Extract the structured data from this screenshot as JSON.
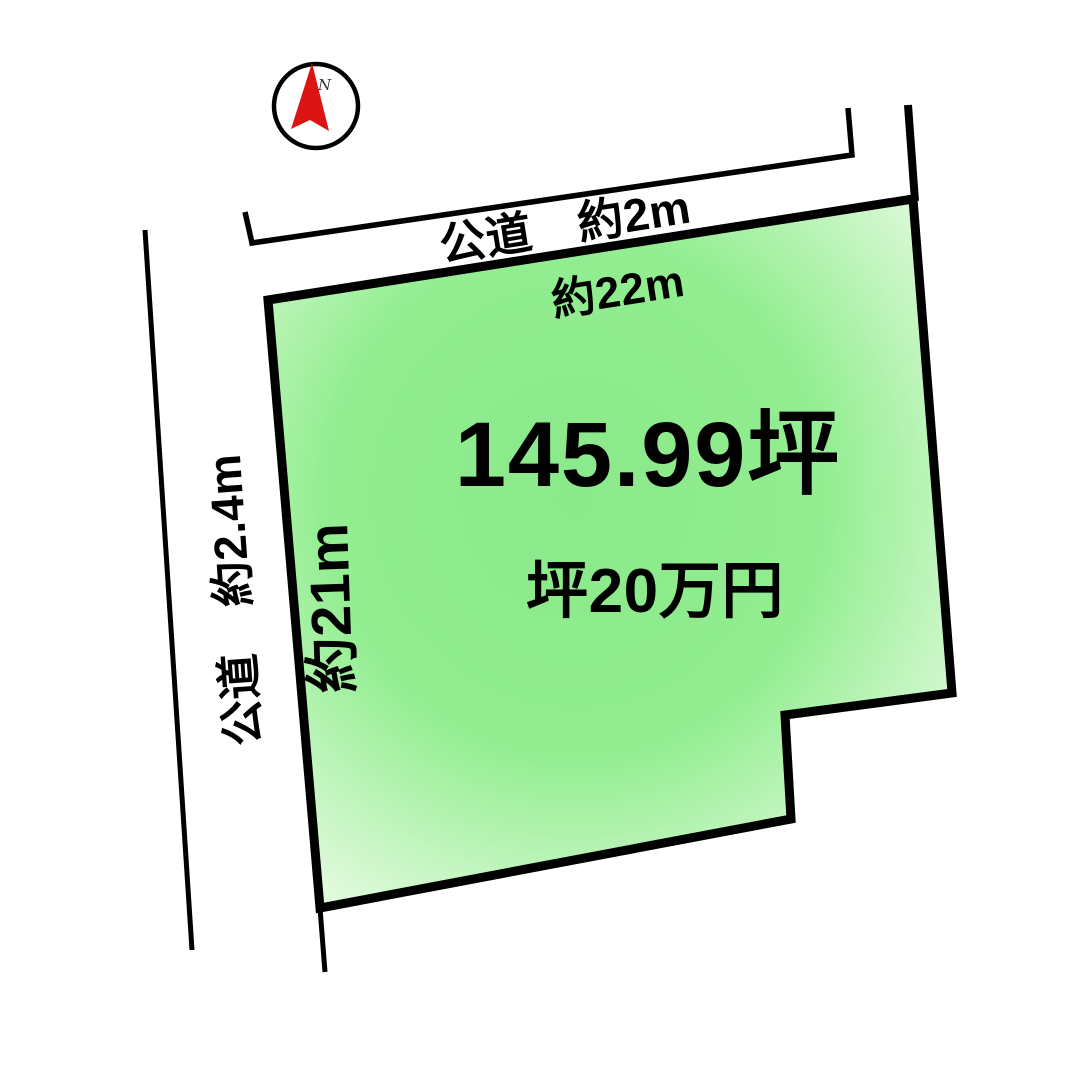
{
  "diagram": {
    "compass": {
      "n_label": "N"
    },
    "roads": [
      {
        "edge": "top",
        "label": "公道　約2m"
      },
      {
        "edge": "left",
        "label": "公道　約2.4m"
      }
    ],
    "dimensions": [
      {
        "edge": "top",
        "label": "約22m"
      },
      {
        "edge": "left",
        "label": "約21m"
      }
    ],
    "parcel": {
      "area_label": "145.99坪",
      "price_label": "坪20万円"
    }
  },
  "colors": {
    "ink": "#000000",
    "bg": "#ffffff",
    "parcel-core": "#8ae98a",
    "parcel-mid": "#92ee90",
    "parcel-edge": "#eafbe5",
    "compass-red": "#dc1414"
  }
}
